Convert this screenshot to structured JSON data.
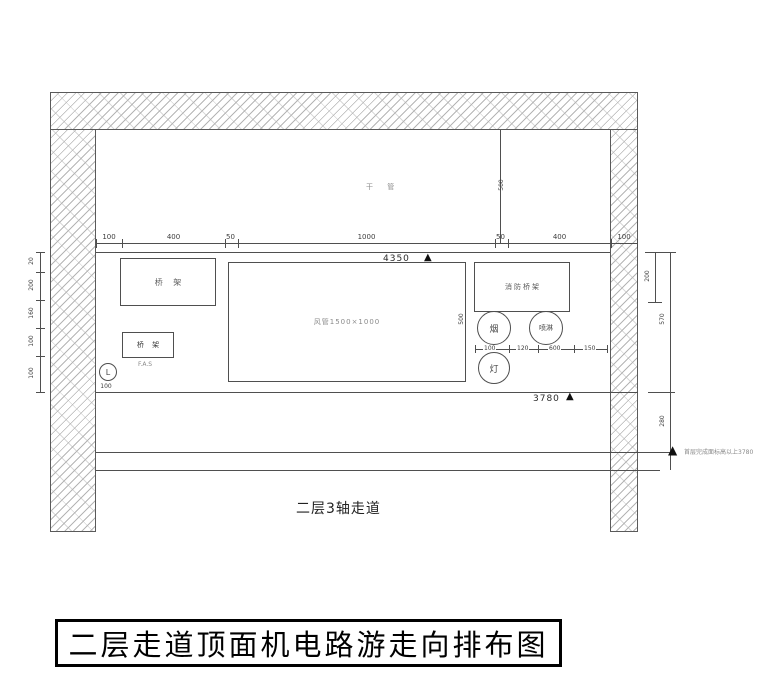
{
  "title_block": {
    "title": "二层走道顶面机电路游走向排布图"
  },
  "plan": {
    "corridor_label": "二层3轴走道",
    "ceiling_pipe_label": "干 管",
    "duct": {
      "label": "风管1500×1000",
      "height_dim": "500"
    },
    "left_tray": {
      "label": "桥 架"
    },
    "right_tray": {
      "label": "消防桥架"
    },
    "fas_tray": {
      "label": "桥 架",
      "sub_label": "F.A.S"
    },
    "levels": {
      "ceiling": "4350",
      "lower": "3780"
    },
    "note_text": "首层完成面标高以上3780",
    "axis_bubble": {
      "label": "L",
      "offset_dim": "100"
    },
    "device_bubbles": [
      {
        "label": "烟"
      },
      {
        "label": "喷淋"
      },
      {
        "label": "灯"
      }
    ],
    "dims": {
      "top": [
        "100",
        "400",
        "50",
        "1000",
        "50",
        "400",
        "100"
      ],
      "ceiling_drop": "500",
      "left": [
        "20",
        "200",
        "160",
        "100",
        "100"
      ],
      "right": [
        "200",
        "570",
        "280"
      ],
      "cluster": [
        "100",
        "120",
        "600",
        "150"
      ]
    }
  }
}
